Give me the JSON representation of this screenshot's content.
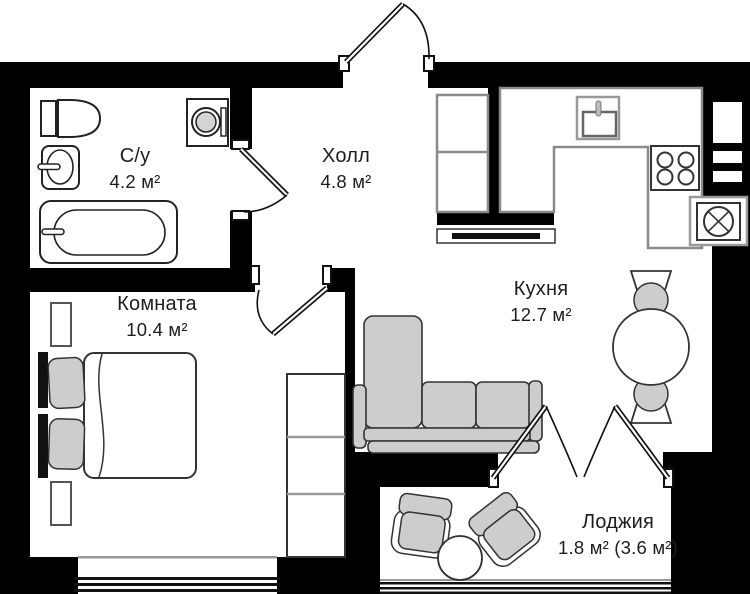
{
  "rooms": [
    {
      "name": "С/у",
      "area": "4.2 м²"
    },
    {
      "name": "Холл",
      "area": "4.8 м²"
    },
    {
      "name": "Кухня",
      "area": "12.7 м²"
    },
    {
      "name": "Комната",
      "area": "10.4 м²"
    },
    {
      "name": "Лоджия",
      "area": "1.8 м² (3.6 м²)"
    }
  ],
  "colors": {
    "wall": "#000000",
    "outline": "#222222",
    "furniture_fill": "#cdcdcd",
    "counter_outline": "#8a8a8a",
    "background": "#ffffff"
  },
  "furniture_icons": [
    "toilet",
    "bathroom-sink",
    "bathtub",
    "washing-machine",
    "hall-wardrobe",
    "doormat",
    "kitchen-counter",
    "kitchen-sink",
    "stove",
    "vent-duct",
    "dining-table",
    "dining-chair",
    "sofa",
    "bed",
    "nightstand",
    "bedroom-wardrobe",
    "armchair",
    "coffee-table",
    "entrance-door",
    "bathroom-door",
    "bedroom-door",
    "french-doors",
    "window"
  ]
}
